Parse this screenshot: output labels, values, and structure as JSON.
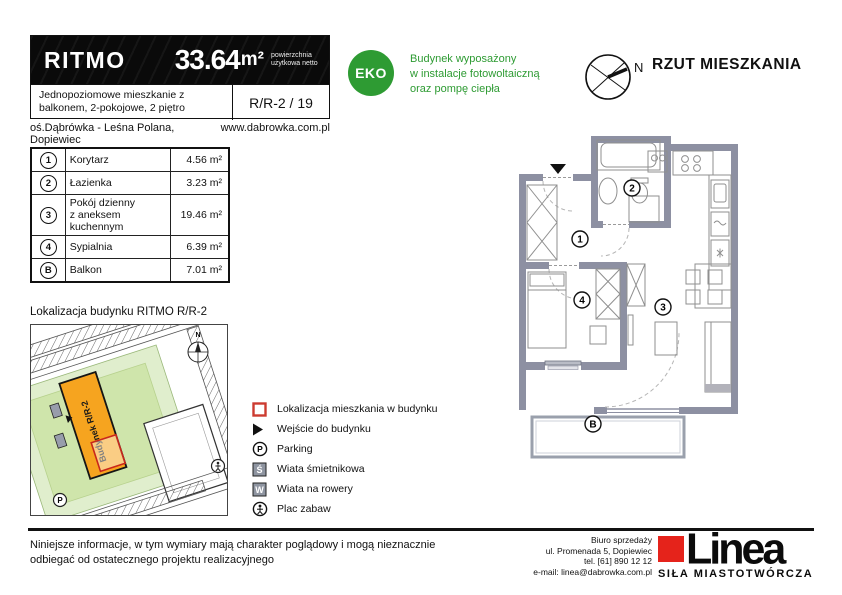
{
  "header": {
    "brand": "RITMO",
    "area_value": "33.64",
    "area_unit": "m²",
    "area_note": "powierzchnia użytkowa netto",
    "description": "Jednopoziomowe mieszkanie z balkonem, 2-pokojowe, 2 piętro",
    "unit_code": "R/R-2 / 19",
    "location": "oś.Dąbrówka - Leśna Polana, Dopiewiec",
    "website": "www.dabrowka.com.pl"
  },
  "eco": {
    "badge": "EKO",
    "line1": "Budynek wyposażony",
    "line2": "w instalacje fotowoltaiczną",
    "line3": "oraz pompę ciepła",
    "color": "#2e9b33"
  },
  "plan": {
    "title": "RZUT MIESZKANIA",
    "north": "N",
    "labels": {
      "r1": "1",
      "r2": "2",
      "r3": "3",
      "r4": "4",
      "balcony": "B"
    },
    "wall_color": "#8d90a2"
  },
  "rooms_table": {
    "rows": [
      {
        "no": "1",
        "name": "Korytarz",
        "name2": "",
        "area": "4.56 m²"
      },
      {
        "no": "2",
        "name": "Łazienka",
        "name2": "",
        "area": "3.23 m²"
      },
      {
        "no": "3",
        "name": "Pokój dzienny",
        "name2": "z aneksem kuchennym",
        "area": "19.46 m²"
      },
      {
        "no": "4",
        "name": "Sypialnia",
        "name2": "",
        "area": "6.39 m²"
      },
      {
        "no": "B",
        "name": "Balkon",
        "name2": "",
        "area": "7.01 m²"
      }
    ]
  },
  "map": {
    "title": "Lokalizacja budynku RITMO R/R-2",
    "building_label": "Budynek R/R-2",
    "north": "N",
    "parking": "P",
    "building_color": "#f6a41f",
    "site_color": "#cfe5ab",
    "highlight_color": "#c9271b"
  },
  "legend": {
    "items": [
      {
        "icon": "apartment-location",
        "label": "Lokalizacja mieszkania w budynku"
      },
      {
        "icon": "building-entrance",
        "label": "Wejście do budynku"
      },
      {
        "icon": "parking",
        "label": "Parking"
      },
      {
        "icon": "trash-shed",
        "label": "Wiata śmietnikowa"
      },
      {
        "icon": "bike-shed",
        "label": "Wiata na rowery"
      },
      {
        "icon": "playground",
        "label": "Plac zabaw"
      }
    ],
    "symbols": {
      "parking": "P",
      "trash": "Ś",
      "bike": "W"
    }
  },
  "footer": {
    "disclaimer_line1": "Niniejsze informacje, w tym wymiary mają charakter poglądowy i mogą nieznacznie",
    "disclaimer_line2": "odbiegać od ostatecznego projektu realizacyjnego",
    "office_line1": "Biuro sprzedaży",
    "office_line2": "ul. Promenada 5, Dopiewiec",
    "office_line3": "tel. [61] 890 12 12",
    "office_line4": "e-mail: linea@dabrowka.com.pl",
    "logo_text": "Linea",
    "logo_tagline": "SIŁA MIASTOTWÓRCZA",
    "logo_color": "#e5231b"
  }
}
